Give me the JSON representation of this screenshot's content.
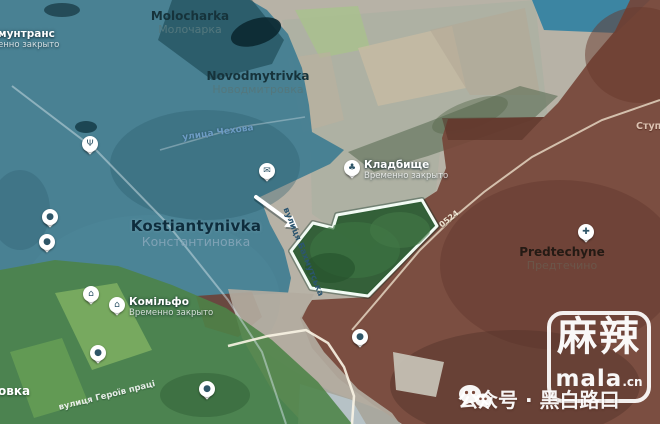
{
  "meta": {
    "width": 660,
    "height": 424
  },
  "colors": {
    "zone_blue": "#3a7a91",
    "zone_red": "#754538",
    "zone_green": "#4c8347",
    "highlight_fill": "#2c5c33",
    "highlight_border": "#f2fbf4",
    "base_terrain": "#b7b2a6"
  },
  "map": {
    "places": [
      {
        "id": "molocharka",
        "en": "Molocharka",
        "alt": "Молочарка",
        "variant": "town",
        "cx": 190,
        "y": 10
      },
      {
        "id": "novodmytrivka",
        "en": "Novodmytrivka",
        "alt": "Новодмитровка",
        "variant": "town",
        "cx": 258,
        "y": 70
      },
      {
        "id": "kostiantynivka",
        "en": "Kostiantynivka",
        "alt": "Константиновка",
        "variant": "city",
        "cx": 196,
        "y": 218
      },
      {
        "id": "predtechyne",
        "en": "Predtechyne",
        "alt": "Предтечино",
        "variant": "brown",
        "cx": 562,
        "y": 246
      },
      {
        "id": "stup",
        "en": "Ступ",
        "alt": "",
        "variant": "minor",
        "lx": 636,
        "y": 122
      },
      {
        "id": "ovka",
        "en": "овка",
        "alt": "",
        "variant": "cutwhite",
        "lx": -2,
        "y": 385
      }
    ],
    "pois": [
      {
        "id": "kommuntrans",
        "label": "мунтранс",
        "sub": "енно закрыто",
        "bare": true,
        "lx": -2,
        "ly": 29
      },
      {
        "id": "vog",
        "label": "Вог",
        "sub": "Временно закрыто",
        "x": 90,
        "y": 144,
        "side": "left",
        "icon": "restaurant-icon",
        "glyph": "Ψ"
      },
      {
        "id": "pekarni",
        "label": "ві пекарні",
        "sub": "но закрыто",
        "x": 50,
        "y": 217,
        "side": "left",
        "icon": "bakery-icon",
        "glyph": "●"
      },
      {
        "id": "yubileiny",
        "label": "лейный",
        "sub": "о закрыто",
        "x": 47,
        "y": 242,
        "side": "left",
        "icon": "shop-icon",
        "glyph": "●"
      },
      {
        "id": "origami",
        "label": "Орігамі",
        "sub": "Временно закрыто",
        "x": 91,
        "y": 294,
        "side": "left",
        "icon": "shop-icon",
        "glyph": "⌂"
      },
      {
        "id": "komilfo",
        "label": "Комільфо",
        "sub": "Временно закрыто",
        "x": 117,
        "y": 305,
        "side": "right",
        "icon": "shop-icon",
        "glyph": "⌂"
      },
      {
        "id": "posad",
        "label": "Посад",
        "sub": "Временно закрыто",
        "x": 98,
        "y": 353,
        "side": "left",
        "icon": "shop-icon",
        "glyph": "●"
      },
      {
        "id": "okko",
        "label": "ОККО",
        "sub": "Временно закрыто",
        "x": 207,
        "y": 389,
        "side": "left",
        "icon": "fuel-icon",
        "glyph": "●"
      },
      {
        "id": "ukrposhta",
        "label": "Укрпошта 85111",
        "sub": "Временно закрыто",
        "x": 267,
        "y": 171,
        "side": "left",
        "icon": "post-icon",
        "glyph": "✉"
      },
      {
        "id": "kladbishche",
        "label": "Кладбище",
        "sub": "Временно закрыто",
        "x": 352,
        "y": 168,
        "side": "right",
        "icon": "cemetery-icon",
        "glyph": "♣"
      },
      {
        "id": "kupava",
        "label": "Магазин \"Купава\"",
        "sub": "Временно закрыто",
        "x": 360,
        "y": 337,
        "side": "left",
        "icon": "shop-icon",
        "glyph": "●"
      },
      {
        "id": "khram",
        "lines": [
          "Храм Усекновения",
          "главы Иоанна Предтечи"
        ],
        "sub": "",
        "x": 586,
        "y": 232,
        "side": "left",
        "icon": "church-icon",
        "glyph": "✚",
        "color": "#f3d2c4"
      }
    ],
    "streets": [
      {
        "id": "chekhova",
        "label": "улица Чехова",
        "x": 218,
        "y": 133,
        "rot": -8,
        "cls": "blue",
        "size": 9
      },
      {
        "id": "bakhmutska",
        "label": "вулиця Бахмутська",
        "x": 303,
        "y": 252,
        "rot": 68,
        "cls": "dark",
        "size": 8.5
      },
      {
        "id": "heroiv",
        "label": "вулиця Героїв праці",
        "x": 107,
        "y": 396,
        "rot": -14,
        "cls": "white",
        "size": 8.5
      },
      {
        "id": "road-0524",
        "label": "0524",
        "x": 449,
        "y": 219,
        "rot": -38,
        "cls": "road",
        "size": 8
      }
    ]
  },
  "watermark": {
    "brand": "麻辣",
    "domain": "mala",
    "domain_suffix": ".cn"
  },
  "caption": {
    "text": "公众号 · 黑白路口"
  }
}
